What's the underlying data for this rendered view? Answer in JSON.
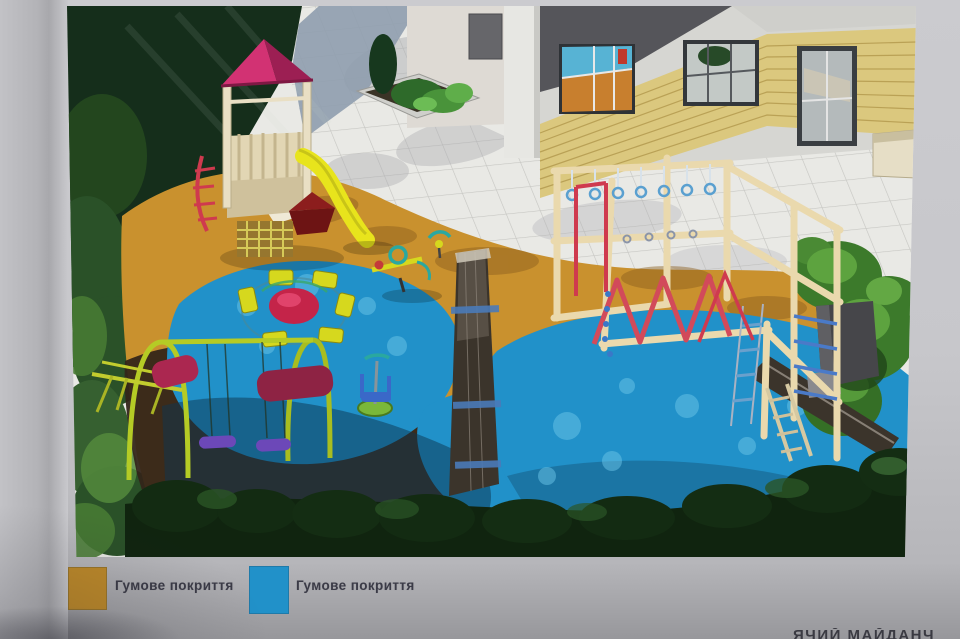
{
  "photo": {
    "page_color": "#c7c7cb",
    "bottom_strip_color": "#97979b",
    "bottom_text_fragment": "ЯЧИЙ МАЙДАНЧ"
  },
  "legend": {
    "items": [
      {
        "label": "Гумове покриття",
        "swatch_color": "#bf8a28"
      },
      {
        "label": "Гумове покриття",
        "swatch_color": "#2191c9"
      }
    ]
  },
  "scene": {
    "surface_orange": "#c9912e",
    "surface_blue": "#2191c9",
    "elements": [
      "play-tower-with-slide",
      "carousel",
      "swing-set",
      "seesaw",
      "spring-riders",
      "spinner",
      "climbing-complex",
      "balance-benches",
      "building-facade",
      "paved-plaza",
      "hedges-and-trees"
    ]
  }
}
